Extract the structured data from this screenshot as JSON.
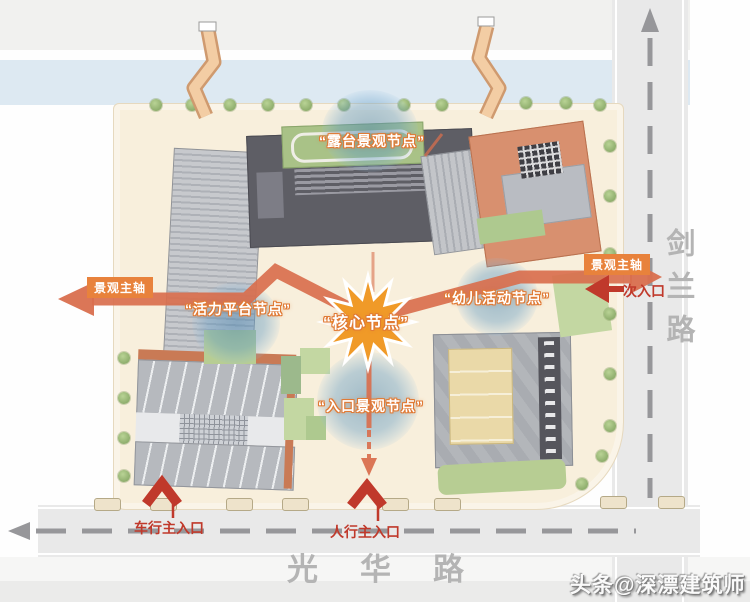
{
  "nodes": {
    "terrace": {
      "label": "“露台景观节点”"
    },
    "core": {
      "label": "“核心节点”"
    },
    "vitality": {
      "label": "“活力平台节点”"
    },
    "children": {
      "label": "“幼儿活动节点”"
    },
    "entrance": {
      "label": "“入口景观节点”"
    }
  },
  "axis": {
    "west_label": "景观主轴",
    "east_label": "景观主轴"
  },
  "entrances": {
    "secondary": "次入口",
    "vehicle_main": "车行主入口",
    "pedestrian_main": "人行主入口"
  },
  "roads": {
    "south": "光华路",
    "east": "剑兰路"
  },
  "watermark": "头条@深漂建筑师",
  "colors": {
    "axis_orange": "#d96f4e",
    "label_box_orange": "#e8823c",
    "entrance_red": "#c0392b",
    "node_blue": "#6ea9cf",
    "star_orange": "#f09a28",
    "site_beige": "#f8efdc",
    "road_gray": "#e9e9e9",
    "road_text_gray": "#b4b4b4",
    "water_blue": "#dde9f2"
  }
}
